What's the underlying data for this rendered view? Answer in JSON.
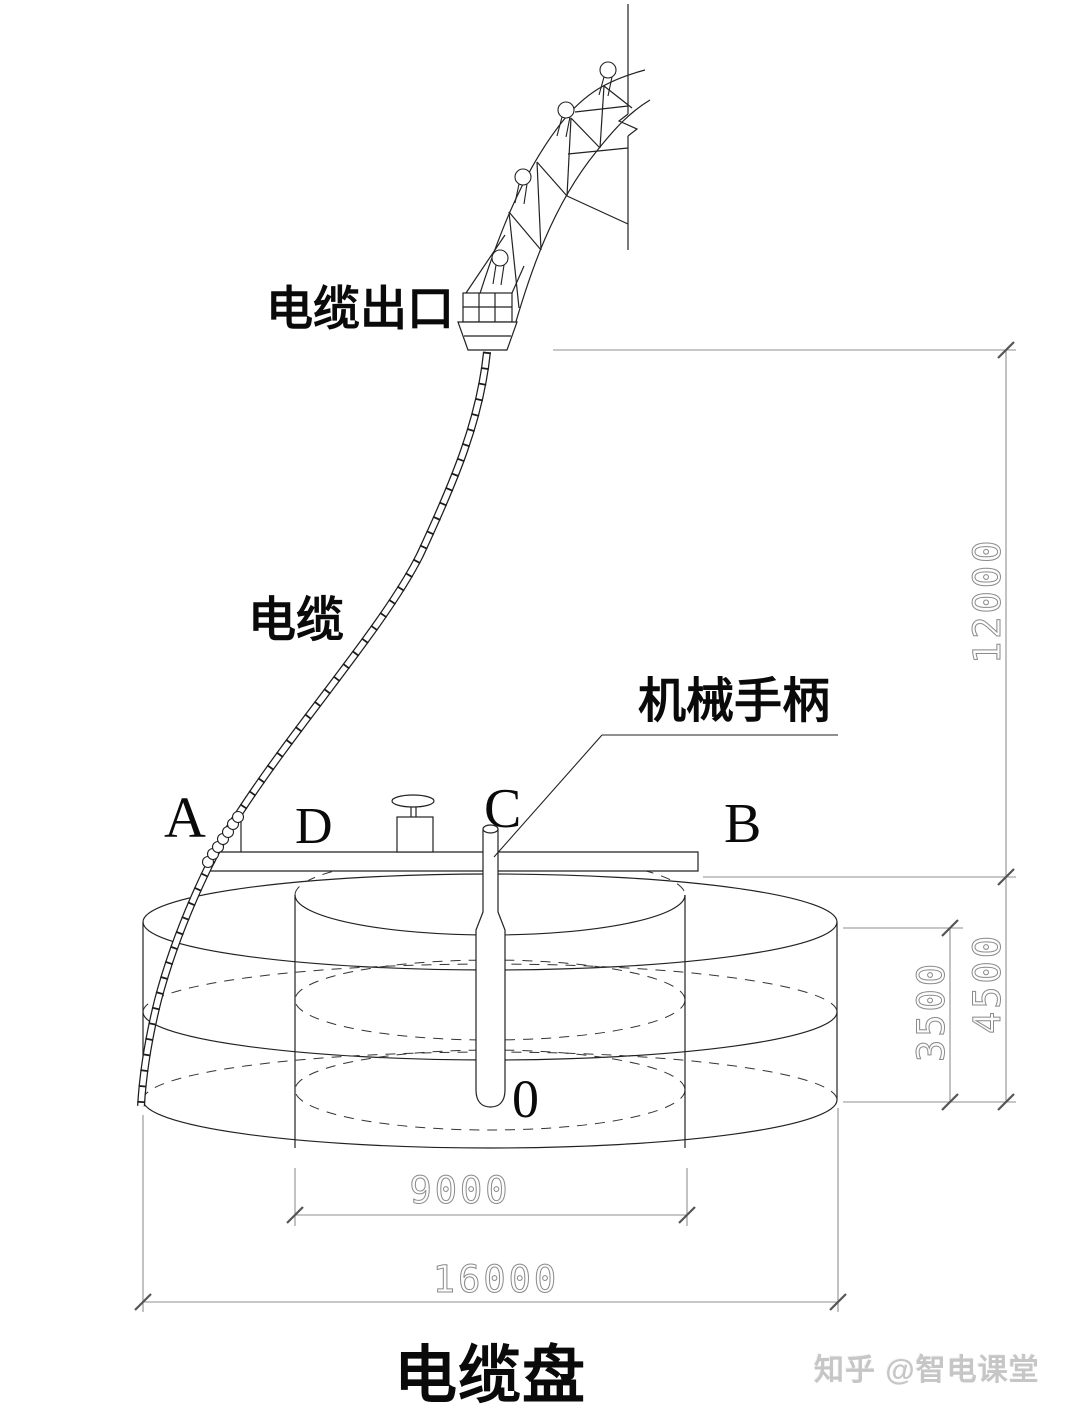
{
  "diagram": {
    "labels": {
      "cable_outlet": "电缆出口",
      "cable": "电缆",
      "mechanical_handle": "机械手柄"
    },
    "points": {
      "a": "A",
      "b": "B",
      "c": "C",
      "d": "D",
      "o": "0"
    },
    "dimensions": {
      "total_height": "12000",
      "drum_height": "4500",
      "inner_height": "3500",
      "inner_diameter": "9000",
      "outer_diameter": "16000"
    },
    "title": "电缆盘",
    "watermark": "知乎 @智电课堂",
    "colors": {
      "line": "#222222",
      "dimension_line": "#8f8f8f",
      "dimension_text": "#8a8a8a",
      "label_text": "#0a0a0a",
      "watermark_text": "#c6c6c6",
      "background": "#ffffff"
    }
  }
}
